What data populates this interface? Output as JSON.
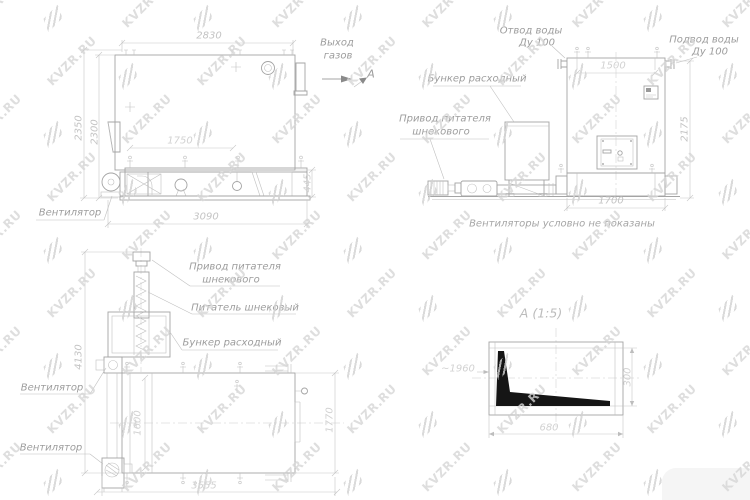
{
  "watermark": {
    "text": "KVZR.RU"
  },
  "side_view": {
    "labels": {
      "gas_outlet_line1": "Выход",
      "gas_outlet_line2": "газов",
      "section_letter": "А",
      "fan": "Вентилятор"
    },
    "dims": {
      "width_top": "2830",
      "height_outer": "2350",
      "height_inner": "2300",
      "grate_inner": "1750",
      "base_height": "445",
      "length_total": "3090"
    }
  },
  "front_view": {
    "labels": {
      "water_outlet_line1": "Отвод воды",
      "water_outlet_line2": "Ду 100",
      "water_supply_line1": "Подвод воды",
      "water_supply_line2": "Ду 100",
      "hopper": "Бункер расходный",
      "drive_line1": "Привод питателя",
      "drive_line2": "шнекового",
      "note": "Вентиляторы условно не показаны"
    },
    "dims": {
      "pipe_spacing": "1500",
      "height": "2175",
      "width": "1700"
    }
  },
  "plan_view": {
    "labels": {
      "drive_line1": "Привод питателя",
      "drive_line2": "шнекового",
      "screw_feeder": "Питатель шнековый",
      "hopper": "Бункер расходный",
      "fan_top": "Вентилятор",
      "fan_bottom": "Вентилятор"
    },
    "dims": {
      "height_total": "4130",
      "width_inner": "1600",
      "width_right": "1770",
      "length": "3555"
    }
  },
  "detail_view": {
    "title": "А (1:5)",
    "ref_length": "~1960",
    "dims": {
      "height": "300",
      "width": "680"
    }
  }
}
